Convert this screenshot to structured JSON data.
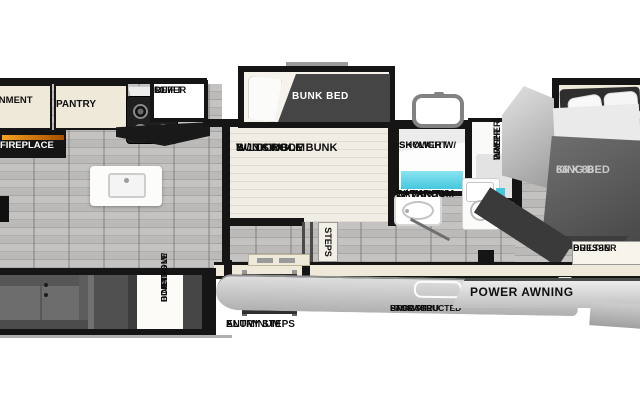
{
  "colors": {
    "wall": "#151515",
    "cream": "#efe9da",
    "accent_cyan": "#45c8de",
    "fireplace_glow": "#ef9417",
    "floor_gray": "#b7b6b4"
  },
  "labels": {
    "entertainment": [
      "ENTERTAINMENT",
      "CENTER"
    ],
    "pantry": "PANTRY",
    "refer": [
      "10.7",
      "CU FT",
      "REFER"
    ],
    "fireplace": "FIREPLACE",
    "bunk_bed": "BUNK BED",
    "bunk_room": [
      "BUNK ROOM",
      "W/ 3 SINGLE",
      "& 1 DOUBLE BUNK"
    ],
    "steps": "STEPS",
    "shower": [
      "SHOWER W/",
      "SKYLIGHT"
    ],
    "washer": [
      "WASHER/",
      "DRYER",
      "PREP"
    ],
    "bathroom": [
      "BATHROOM",
      "W/ VANITY"
    ],
    "king_bed": [
      "66 X 80",
      "KING BED"
    ],
    "dresser": [
      "BUILT-IN",
      "DRESSER"
    ],
    "dinette": [
      "BOOTH",
      "DINETTE W/",
      "CORNHOLE",
      "BOARDS"
    ],
    "entry_steps": [
      "ALUMINUM",
      "ENTRY STEPS"
    ],
    "pass_thru": [
      "UNOBSTRUCTED",
      "PASS-THRU",
      "STORAGE"
    ],
    "power_awning": "POWER AWNING"
  }
}
